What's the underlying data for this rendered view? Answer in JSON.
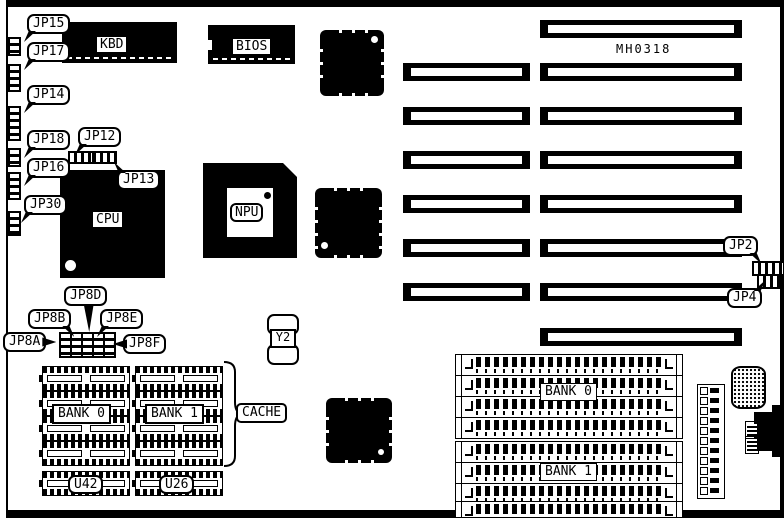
{
  "part_number": "MH0318",
  "callouts": {
    "jp15": "JP15",
    "jp17": "JP17",
    "jp14": "JP14",
    "jp18": "JP18",
    "jp12": "JP12",
    "jp16": "JP16",
    "jp13": "JP13",
    "jp30": "JP30",
    "jp8d": "JP8D",
    "jp8b": "JP8B",
    "jp8e": "JP8E",
    "jp8a": "JP8A",
    "jp8f": "JP8F",
    "jp2": "JP2",
    "jp4": "JP4",
    "cache": "CACHE"
  },
  "components": {
    "kbd": "KBD",
    "bios": "BIOS",
    "cpu": "CPU",
    "npu": "NPU",
    "crystal": "Y2"
  },
  "memory": {
    "dip_bank0": "BANK 0",
    "dip_bank1": "BANK 1",
    "u42": "U42",
    "u26": "U26",
    "simm_bank0": "BANK 0",
    "simm_bank1": "BANK 1"
  },
  "colors": {
    "ink": "#000000",
    "paper": "#ffffff"
  }
}
